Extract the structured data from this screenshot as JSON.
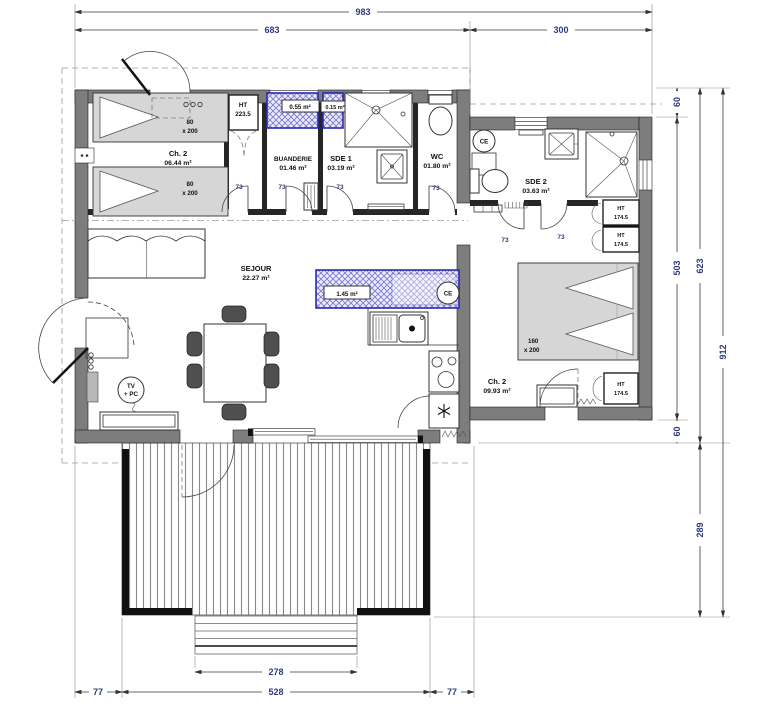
{
  "dims": {
    "total_width": "983",
    "left_width": "683",
    "right_width": "300",
    "overhang_top": "60",
    "wing_height": "503",
    "overhang_bottom": "60",
    "body_height": "623",
    "total_height": "912",
    "terrace_height": "289",
    "steps_width": "278",
    "left_offset": "77",
    "terrace_width": "528",
    "right_offset": "77"
  },
  "rooms": {
    "ch2_left": {
      "name": "Ch. 2",
      "area": "06.44 m²"
    },
    "buanderie": {
      "name": "BUANDERIE",
      "area": "01.46 m²"
    },
    "sde1": {
      "name": "SDE 1",
      "area": "03.19 m²"
    },
    "wc": {
      "name": "WC",
      "area": "01.80 m²"
    },
    "sde2": {
      "name": "SDE 2",
      "area": "03.63 m²"
    },
    "sejour": {
      "name": "SEJOUR",
      "area": "22.27 m²"
    },
    "ch2_right": {
      "name": "Ch. 2",
      "area": "09.93 m²"
    }
  },
  "labels": {
    "ht": "HT",
    "ht_tall": "223.5",
    "ht_low": "174.5",
    "duct_a": "0.55 m²",
    "duct_b": "0.15 m²",
    "duct_kitchen": "1.45 m²",
    "water_heater": "CE",
    "tv": "TV",
    "pc": "+ PC",
    "single_bed_w": "80",
    "single_bed_l": "x 200",
    "double_bed_w": "160",
    "double_bed_l": "x 200",
    "door_width": "73"
  },
  "colors": {
    "wall_gray": "#7d7d7d",
    "duct_blue": "#2a2ab0",
    "dim_text": "#2e3b7d"
  }
}
